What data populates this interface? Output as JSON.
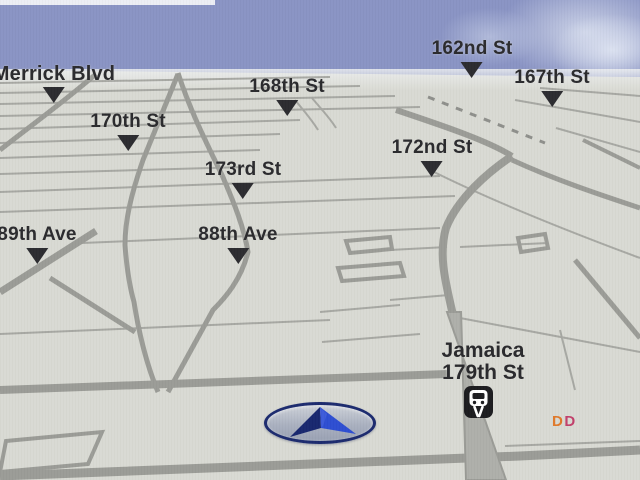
{
  "scene": {
    "description": "car navigation system 3D map view, Jamaica Queens NY area"
  },
  "colors": {
    "sky": "#8a94c4",
    "cloud": "#d8deee",
    "ground": "#d9dad3",
    "road_minor": "#a7a8a3",
    "road_major": "#9b9c97",
    "road_wide_fill": "#aeafaa",
    "label_text": "#2b2b2e",
    "marker": "#2c2c30",
    "station_icon_bg": "#1c1c1f",
    "vehicle_ring": "#1c2b6e",
    "vehicle_arrow_dark": "#18276f",
    "vehicle_arrow_light": "#2e4ed2",
    "poi_d1": "#e0792b",
    "poi_d2": "#c2406b"
  },
  "street_labels": [
    {
      "text": "Merrick Blvd",
      "cx": 54,
      "top": 64,
      "big": true
    },
    {
      "text": "170th St",
      "cx": 128,
      "top": 112,
      "big": false
    },
    {
      "text": "168th St",
      "cx": 287,
      "top": 77,
      "big": false
    },
    {
      "text": "162nd St",
      "cx": 472,
      "top": 39,
      "big": false
    },
    {
      "text": "167th St",
      "cx": 552,
      "top": 68,
      "big": false
    },
    {
      "text": "172nd St",
      "cx": 432,
      "top": 138,
      "big": false
    },
    {
      "text": "173rd St",
      "cx": 243,
      "top": 160,
      "big": false
    },
    {
      "text": "89th Ave",
      "cx": 37,
      "top": 225,
      "big": false
    },
    {
      "text": "88th Ave",
      "cx": 238,
      "top": 225,
      "big": false
    }
  ],
  "station": {
    "line1": "Jamaica",
    "line2": "179th St",
    "icon": "train-station-icon"
  },
  "poi": {
    "letters": [
      {
        "char": "D",
        "color": "#e0792b"
      },
      {
        "char": "D",
        "color": "#c2406b"
      }
    ],
    "brand_hint": "DD"
  },
  "vehicle": {
    "label": "current-position-arrow"
  }
}
